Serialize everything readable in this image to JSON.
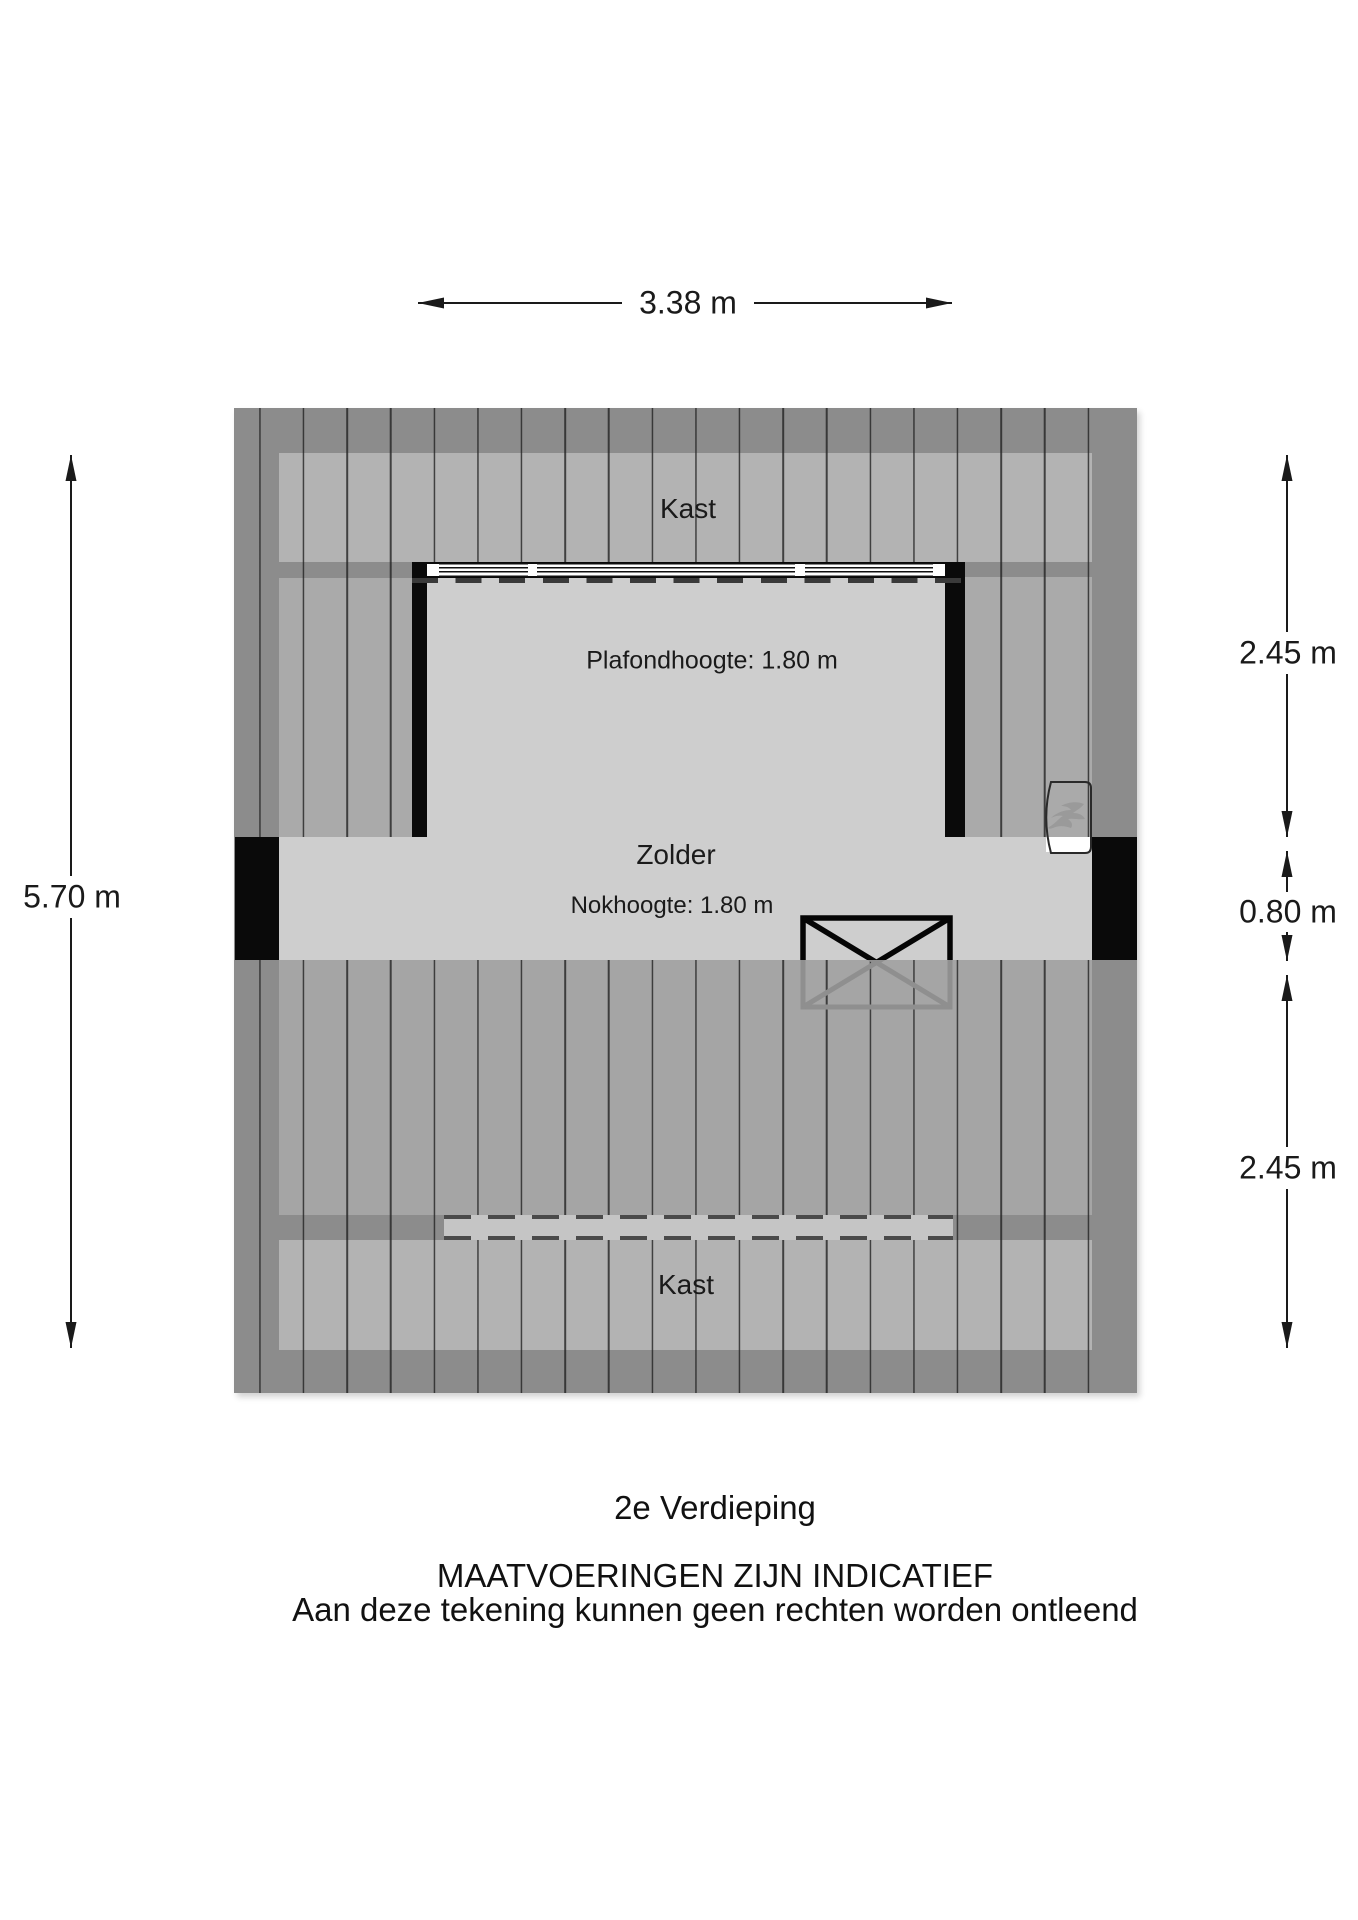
{
  "plan": {
    "rooms": {
      "kast_top": "Kast",
      "kast_bottom": "Kast",
      "zolder": "Zolder",
      "plafondhoogte": "Plafondhoogte: 1.80 m",
      "nokhoogte": "Nokhoogte: 1.80 m"
    },
    "icons": {
      "boiler_icon": "flame",
      "stairwell_icon": "crossed-opening"
    }
  },
  "dimensions": {
    "top": "3.38 m",
    "left": "5.70 m",
    "right_upper": "2.45 m",
    "right_middle": "0.80 m",
    "right_lower": "2.45 m"
  },
  "footer": {
    "floor_label": "2e Verdieping",
    "disclaimer_line1": "MAATVOERINGEN ZIJN INDICATIEF",
    "disclaimer_line2": "Aan deze tekening kunnen geen rechten worden ontleend"
  },
  "colors": {
    "wall_band": "#8c8c8c",
    "roof_hatch_side": "#aaaaaa",
    "roof_hatch_bottom": "#a5a5a5",
    "closet_band": "#b3b3b3",
    "room_floor": "#cecece",
    "wall_black": "#0a0a0a",
    "dimension_text": "#1a1a1a"
  }
}
